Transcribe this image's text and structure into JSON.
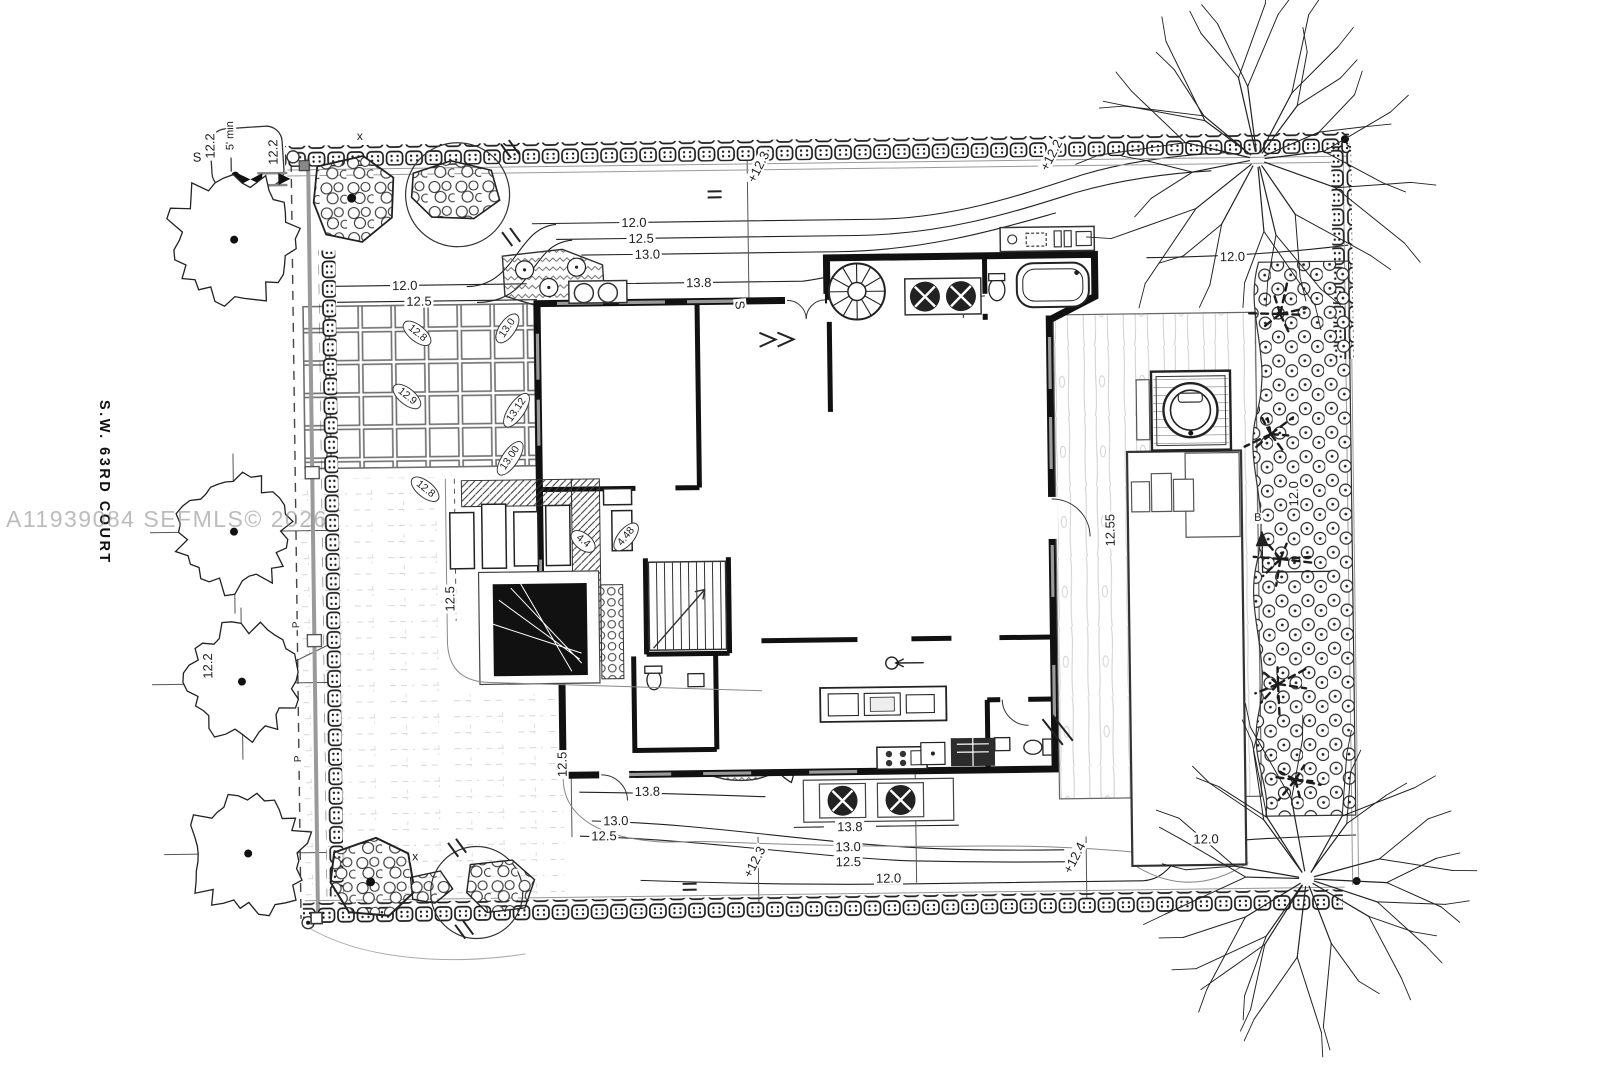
{
  "meta": {
    "watermark": "A11939084 SEFMLS© 2026",
    "street_label": "S.W. 63RD COURT"
  },
  "colors": {
    "ink": "#1d1d1d",
    "light_line": "#999999",
    "lawn_line": "#d2d2d2",
    "wood_line": "#cfcfcf",
    "watermark_gray": "#8c8c8c",
    "background": "#ffffff"
  },
  "annotations": [
    {
      "name": "contour-12-0-topleft",
      "text": "12.0",
      "x": 408,
      "y": 280
    },
    {
      "name": "contour-12-5-topleft",
      "text": "12.5",
      "x": 422,
      "y": 296
    },
    {
      "name": "contour-12-0-top",
      "text": "12.0",
      "x": 638,
      "y": 220
    },
    {
      "name": "contour-12-5-top",
      "text": "12.5",
      "x": 645,
      "y": 236
    },
    {
      "name": "contour-13-0-top",
      "text": "13.0",
      "x": 651,
      "y": 252
    },
    {
      "name": "contour-13-8-top",
      "text": "13.8",
      "x": 702,
      "y": 281
    },
    {
      "name": "spot-plus-12-3-top",
      "text": "+12.3",
      "x": 763,
      "y": 166,
      "rot": -62
    },
    {
      "name": "spot-plus-12-2-top",
      "text": "+12.2",
      "x": 1056,
      "y": 158,
      "rot": -62
    },
    {
      "name": "contour-12-0-topright",
      "text": "12.0",
      "x": 1236,
      "y": 262
    },
    {
      "name": "dim-12-2-a",
      "text": "12.2",
      "x": 215,
      "y": 138,
      "rot": -90
    },
    {
      "name": "dim-12-2-b",
      "text": "12.2",
      "x": 278,
      "y": 145,
      "rot": -90
    },
    {
      "name": "note-5ft-min",
      "text": "5' min",
      "x": 236,
      "y": 128,
      "rot": -90,
      "size": 11
    },
    {
      "name": "mark-s-topleft",
      "text": "S",
      "x": 202,
      "y": 149
    },
    {
      "name": "dim-12-2-c",
      "text": "12.2",
      "x": 206,
      "y": 658,
      "rot": -90
    },
    {
      "name": "mark-p-a",
      "text": "P",
      "x": 296,
      "y": 618,
      "rot": -90,
      "size": 10
    },
    {
      "name": "mark-p-b",
      "text": "P",
      "x": 296,
      "y": 752,
      "rot": -90,
      "size": 10
    },
    {
      "name": "mark-x-a",
      "text": "x",
      "x": 365,
      "y": 130,
      "size": 12
    },
    {
      "name": "mark-x-b",
      "text": "x",
      "x": 411,
      "y": 851,
      "size": 12
    },
    {
      "name": "spot-12-8-a",
      "text": "12.8",
      "x": 420,
      "y": 328,
      "rot": 40,
      "tag": true
    },
    {
      "name": "spot-13-0",
      "text": "13.0",
      "x": 510,
      "y": 324,
      "rot": -55,
      "tag": true
    },
    {
      "name": "spot-12-9",
      "text": "12.9",
      "x": 409,
      "y": 391,
      "rot": 40,
      "tag": true
    },
    {
      "name": "spot-13-12",
      "text": "13.12",
      "x": 518,
      "y": 406,
      "rot": -55,
      "tag": true
    },
    {
      "name": "spot-13-00",
      "text": "13.00",
      "x": 511,
      "y": 454,
      "rot": -55,
      "tag": true
    },
    {
      "name": "spot-12-8-b",
      "text": "12.8",
      "x": 426,
      "y": 484,
      "rot": 40,
      "tag": true
    },
    {
      "name": "spot-4-4",
      "text": "4.4",
      "x": 583,
      "y": 538,
      "rot": 40,
      "tag": true
    },
    {
      "name": "spot-4-48",
      "text": "4.48",
      "x": 626,
      "y": 534,
      "rot": -50,
      "tag": true
    },
    {
      "name": "dim-12-5-courtyard",
      "text": "12.5",
      "x": 449,
      "y": 594,
      "rot": -90
    },
    {
      "name": "dim-12-5-patio",
      "text": "12.5",
      "x": 559,
      "y": 761,
      "rot": -90
    },
    {
      "name": "contour-13-8-bottomleft",
      "text": "13.8",
      "x": 644,
      "y": 789
    },
    {
      "name": "contour-13-0-bottomleft",
      "text": "13.0",
      "x": 612,
      "y": 818
    },
    {
      "name": "contour-12-5-bottomleft",
      "text": "12.5",
      "x": 600,
      "y": 833
    },
    {
      "name": "pad-13-8",
      "text": "13.8",
      "x": 846,
      "y": 827
    },
    {
      "name": "contour-13-0-bottom",
      "text": "13.0",
      "x": 844,
      "y": 847
    },
    {
      "name": "contour-12-5-bottom",
      "text": "12.5",
      "x": 844,
      "y": 862
    },
    {
      "name": "contour-12-0-bottom",
      "text": "12.0",
      "x": 884,
      "y": 879
    },
    {
      "name": "spot-plus-12-3-bottom",
      "text": "+12.3",
      "x": 750,
      "y": 861,
      "rot": -62
    },
    {
      "name": "spot-plus-12-4-bottom",
      "text": "+12.4",
      "x": 1070,
      "y": 861,
      "rot": -62
    },
    {
      "name": "contour-12-0-bottomright",
      "text": "12.0",
      "x": 1202,
      "y": 844
    },
    {
      "name": "dim-12-55-pool",
      "text": "12.55",
      "x": 1110,
      "y": 534,
      "rot": -90
    },
    {
      "name": "dim-12-0-right",
      "text": "12.0",
      "x": 1294,
      "y": 500,
      "rot": -90
    },
    {
      "name": "section-b-label",
      "text": "B",
      "x": 1258,
      "y": 524,
      "size": 11
    },
    {
      "name": "mark-s-contour",
      "text": "S",
      "x": 743,
      "y": 304,
      "rot": 85
    }
  ]
}
